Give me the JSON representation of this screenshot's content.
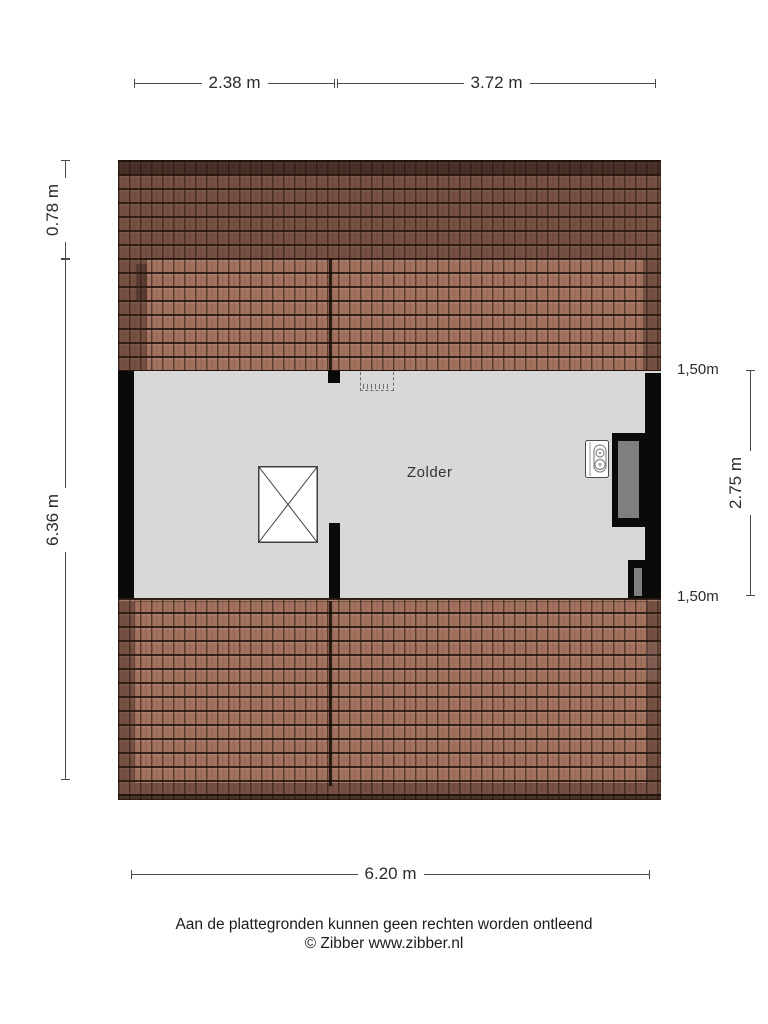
{
  "title": "Zolder floor plan",
  "room": {
    "label": "Zolder"
  },
  "dimensions": {
    "top": [
      {
        "label": "2.38 m"
      },
      {
        "label": "3.72 m"
      }
    ],
    "left": [
      {
        "label": "0.78 m"
      },
      {
        "label": "6.36 m"
      }
    ],
    "right": [
      {
        "label": "1,50m"
      },
      {
        "label": "2.75 m"
      },
      {
        "label": "1,50m"
      }
    ],
    "bottom": [
      {
        "label": "6.20 m"
      }
    ]
  },
  "icons": [
    {
      "name": "boiler-icon"
    },
    {
      "name": "stairwell-cross-icon"
    },
    {
      "name": "roof-hatch-dashed-icon"
    }
  ],
  "footer": {
    "disclaimer": "Aan de plattegronden kunnen geen rechten worden ontleend",
    "credit": "© Zibber www.zibber.nl"
  },
  "colors": {
    "background": "#ffffff",
    "floor": "#d8d8d8",
    "wall": "#0a0a0a",
    "roof_tile": "#a3725f",
    "roof_shade": "#50342a",
    "panel_gray": "#7f7f7f",
    "dimension_line": "#4a4a4a",
    "text": "#2b2b2b"
  }
}
